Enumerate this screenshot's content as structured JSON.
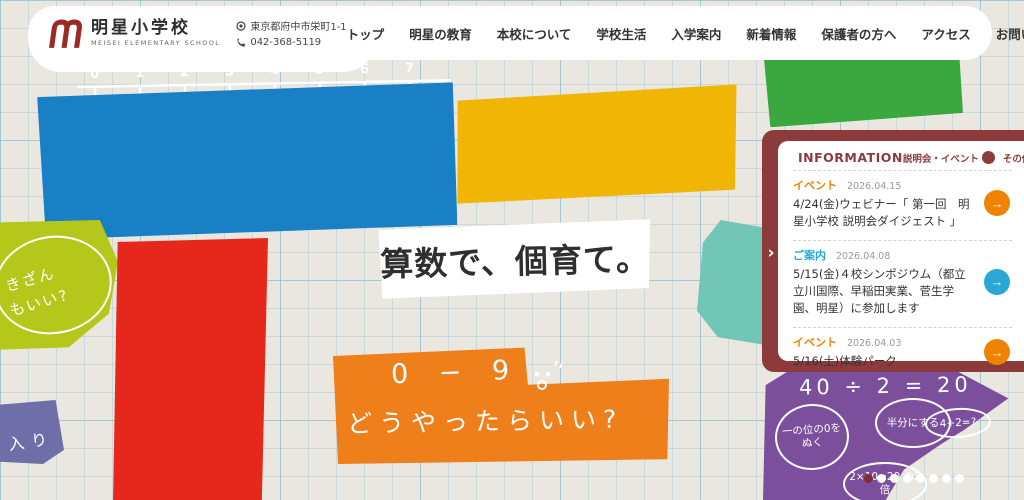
{
  "header": {
    "logo": {
      "title": "明星小学校",
      "subtitle": "MEISEI ELEMENTARY SCHOOL",
      "mark_color": "#9a2b24"
    },
    "contact": {
      "address": "東京都府中市栄町1-1",
      "phone": "042-368-5119"
    },
    "nav": [
      "トップ",
      "明星の教育",
      "本校について",
      "学校生活",
      "入学案内",
      "新着情報",
      "保護者の方へ",
      "アクセス",
      "お問い合わせ"
    ]
  },
  "hero": {
    "headline": "算数で、個育て。",
    "doodles": {
      "blue": {
        "color": "#1a80c6",
        "numbers": [
          "0",
          "1",
          "2",
          "3",
          "4",
          "5",
          "6",
          "7"
        ],
        "word1": "マス",
        "word2": "くん",
        "word3": "だよ",
        "word4": "よろしく"
      },
      "yellow": {
        "color": "#f0b505",
        "equation": "2 × 3 = 6",
        "side_char": "す"
      },
      "green": {
        "color": "#3aa83f",
        "bubble": "2つありそう"
      },
      "lime": {
        "color": "#b6c71c",
        "line1": "きざん",
        "line2": "もいい?"
      },
      "red": {
        "color": "#e6281c",
        "n7": "7",
        "n8": "+8",
        "eq5": "=5",
        "plus": "+",
        "n10": "10",
        "n15": "15"
      },
      "orange": {
        "color": "#ee7f1a",
        "line1": "0 − 9",
        "line2": "どうやったらいい?"
      },
      "purple": {
        "color": "#7b4f9c",
        "equation": "40 ÷ 2 = 20",
        "bubble1": "一の位の0をぬく",
        "bubble2": "半分にする",
        "bubble3": "4÷2=?",
        "bubble4": "2×10=20 の2倍"
      },
      "navy": {
        "color": "#6f6ea9",
        "text": "入り"
      },
      "teal": {
        "color": "#72c6b6"
      }
    }
  },
  "info_panel": {
    "frame_color": "#8d3a3d",
    "chevron_glyph": "›",
    "title": "INFORMATION",
    "filters": [
      {
        "label": "説明会・イベント",
        "icon": "arrow-down-circle-icon",
        "glyph": "↓"
      },
      {
        "label": "その他",
        "icon": "arrow-down-circle-icon",
        "glyph": "↓"
      }
    ],
    "items": [
      {
        "category": "イベント",
        "category_color": "#ef8200",
        "date": "2026.04.15",
        "title": "4/24(金)ウェビナー「 第一回　明星小学校 説明会ダイジェスト 」",
        "arrow_glyph": "→",
        "arrow_color": "#ef8200"
      },
      {
        "category": "ご案内",
        "category_color": "#29a8d8",
        "date": "2026.04.08",
        "title": "5/15(金)４校シンポジウム（都立立川国際、早稲田実業、菅生学園、明星）に参加します",
        "arrow_glyph": "→",
        "arrow_color": "#29a8d8"
      },
      {
        "category": "イベント",
        "category_color": "#ef8200",
        "date": "2026.04.03",
        "title": "5/16(土)体験パーク",
        "arrow_glyph": "→",
        "arrow_color": "#ef8200"
      }
    ]
  },
  "pagination": {
    "total": 8,
    "active_index": 0
  }
}
